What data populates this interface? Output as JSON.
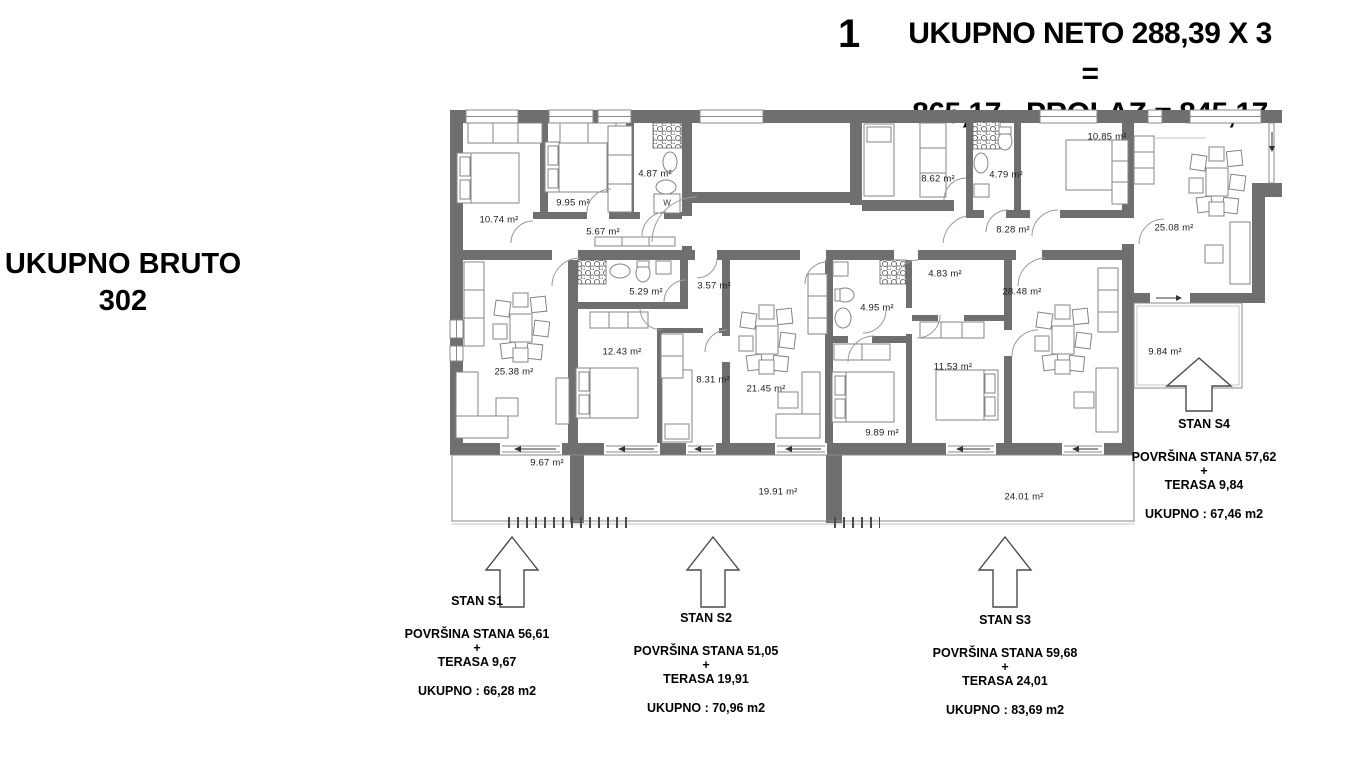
{
  "header": {
    "floor_number": "1",
    "summary_line1": "UKUPNO NETO 288,39 X 3 =",
    "summary_line2": "865,17 - PROLAZ = 845,17"
  },
  "side_note": {
    "line1": "UKUPNO BRUTO",
    "line2": "302"
  },
  "plan": {
    "washer_label": "W",
    "room_labels": [
      {
        "text": "10.74 m²",
        "x": 499,
        "y": 220
      },
      {
        "text": "9.95 m²",
        "x": 573,
        "y": 203
      },
      {
        "text": "4.87 m²",
        "x": 655,
        "y": 174
      },
      {
        "text": "5.67 m²",
        "x": 603,
        "y": 232
      },
      {
        "text": "8.62 m²",
        "x": 938,
        "y": 179
      },
      {
        "text": "4.79 m²",
        "x": 1006,
        "y": 175
      },
      {
        "text": "10.85 m²",
        "x": 1107,
        "y": 137
      },
      {
        "text": "8.28 m²",
        "x": 1013,
        "y": 230
      },
      {
        "text": "25.08 m²",
        "x": 1174,
        "y": 228
      },
      {
        "text": "25.38 m²",
        "x": 514,
        "y": 372
      },
      {
        "text": "5.29 m²",
        "x": 646,
        "y": 292
      },
      {
        "text": "3.57 m²",
        "x": 714,
        "y": 286
      },
      {
        "text": "12.43 m²",
        "x": 622,
        "y": 352
      },
      {
        "text": "8.31 m²",
        "x": 713,
        "y": 380
      },
      {
        "text": "21.45 m²",
        "x": 766,
        "y": 389
      },
      {
        "text": "4.95 m²",
        "x": 877,
        "y": 308
      },
      {
        "text": "4.83 m²",
        "x": 945,
        "y": 274
      },
      {
        "text": "9.89 m²",
        "x": 882,
        "y": 433
      },
      {
        "text": "11.53 m²",
        "x": 953,
        "y": 367
      },
      {
        "text": "28.48 m²",
        "x": 1022,
        "y": 292
      },
      {
        "text": "9.84 m²",
        "x": 1165,
        "y": 352
      },
      {
        "text": "9.67 m²",
        "x": 547,
        "y": 463
      },
      {
        "text": "19.91 m²",
        "x": 778,
        "y": 492
      },
      {
        "text": "24.01 m²",
        "x": 1024,
        "y": 497
      }
    ]
  },
  "apartments": [
    {
      "name": "STAN S1",
      "area": "POVRŠINA STANA  56,61",
      "plus": "+",
      "terrace": "TERASA 9,67",
      "total": "UKUPNO : 66,28 m2"
    },
    {
      "name": "STAN S2",
      "area": "POVRŠINA STANA  51,05",
      "plus": "+",
      "terrace": "TERASA 19,91",
      "total": "UKUPNO : 70,96 m2"
    },
    {
      "name": "STAN S3",
      "area": "POVRŠINA STANA  59,68",
      "plus": "+",
      "terrace": "TERASA 24,01",
      "total": "UKUPNO : 83,69 m2"
    },
    {
      "name": "STAN S4",
      "area": "POVRŠINA STANA  57,62",
      "plus": "+",
      "terrace": "TERASA 9,84",
      "total": "UKUPNO : 67,46 m2"
    }
  ],
  "colors": {
    "wall": "#6f6f6f",
    "thin_line": "#8a8a8a",
    "text": "#111111"
  }
}
